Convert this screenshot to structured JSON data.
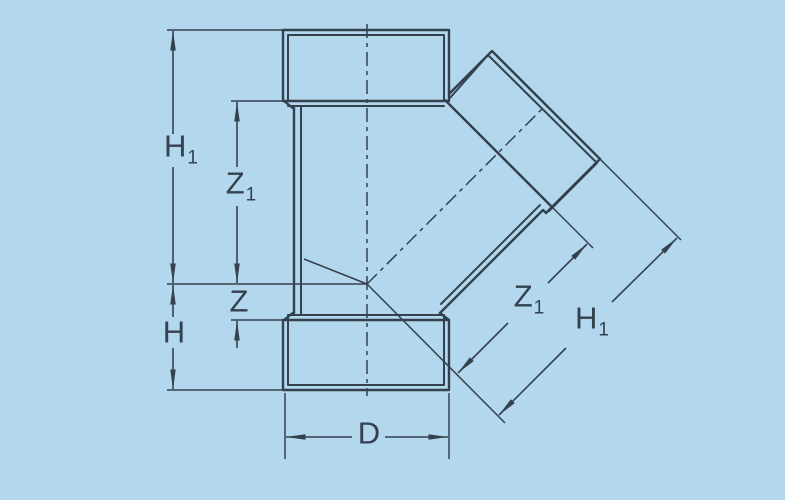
{
  "figure": {
    "description": "Dimension drawing of a 45-degree wye (Y-branch) pipe fitting shown in outline with centerlines and dimension arrows"
  },
  "labels": {
    "h1_left": {
      "base": "H",
      "sub": "1"
    },
    "z1_left": {
      "base": "Z",
      "sub": "1"
    },
    "z_left": {
      "base": "Z",
      "sub": ""
    },
    "h_left": {
      "base": "H",
      "sub": ""
    },
    "d_bottom": {
      "base": "D",
      "sub": ""
    },
    "z1_branch": {
      "base": "Z",
      "sub": "1"
    },
    "h1_branch": {
      "base": "H",
      "sub": "1"
    }
  },
  "colors": {
    "background": "#b3d7ed",
    "line": "#34414e"
  }
}
